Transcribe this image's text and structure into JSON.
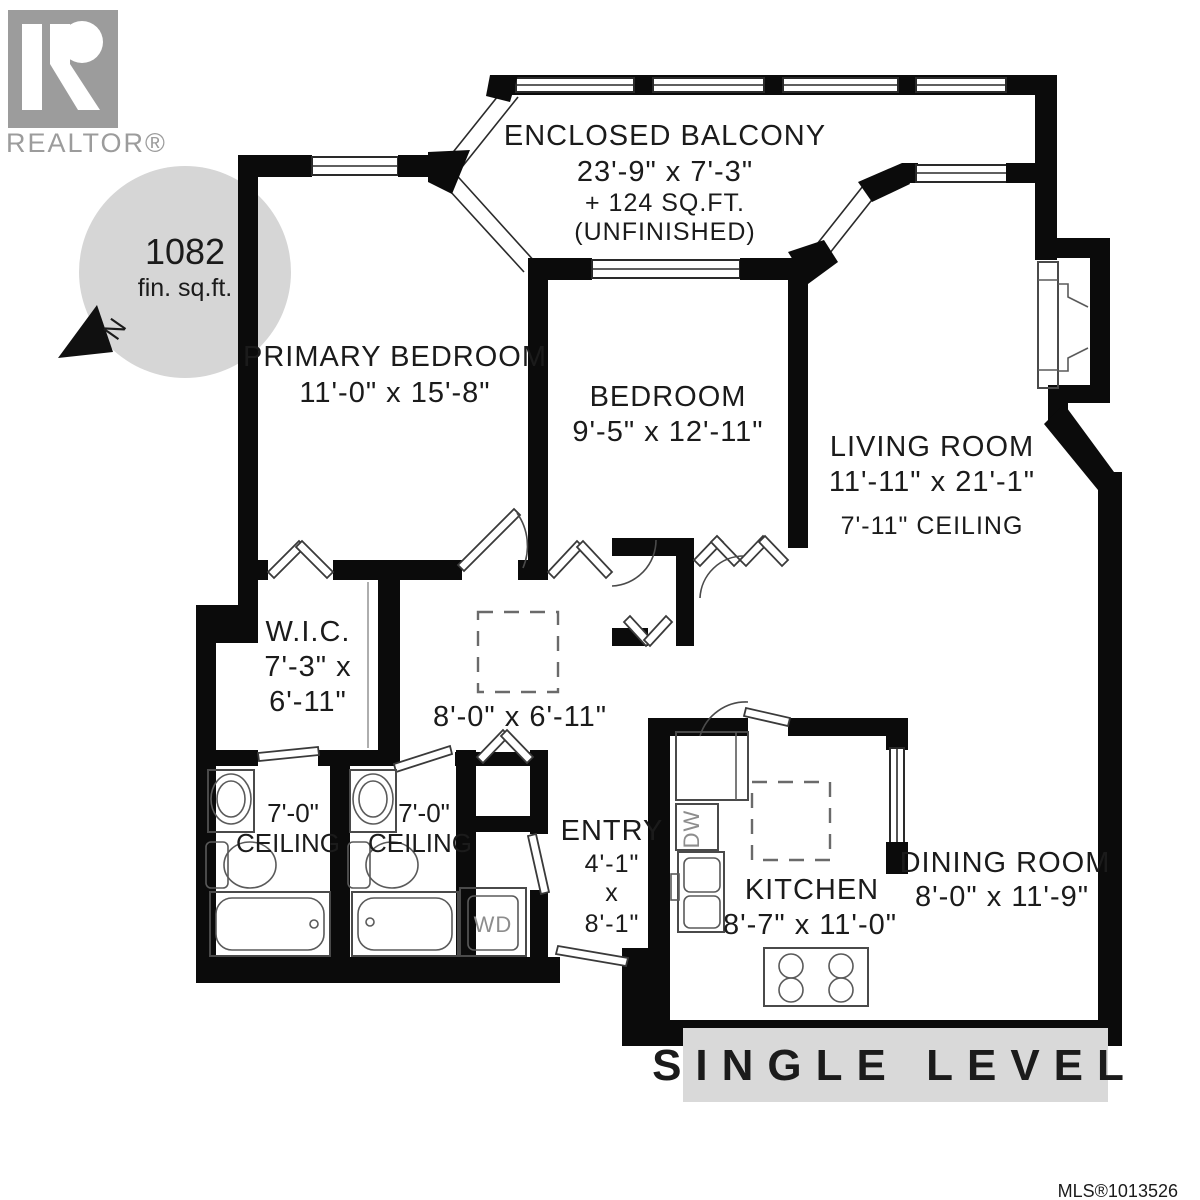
{
  "branding": {
    "realtor_logo_label": "REALTOR®",
    "mls_number": "MLS®1013526"
  },
  "area_badge": {
    "value": "1082",
    "unit": "fin. sq.ft.",
    "north_label": "N"
  },
  "banner": {
    "label": "SINGLE LEVEL"
  },
  "rooms": {
    "balcony": {
      "name": "ENCLOSED BALCONY",
      "dims": "23'-9\" x 7'-3\"",
      "extra_area": "+ 124 SQ.FT.",
      "note": "(UNFINISHED)"
    },
    "primary_bedroom": {
      "name": "PRIMARY BEDROOM",
      "dims": "11'-0\" x 15'-8\""
    },
    "bedroom": {
      "name": "BEDROOM",
      "dims": "9'-5\" x 12'-11\""
    },
    "living_room": {
      "name": "LIVING ROOM",
      "dims": "11'-11\" x 21'-1\"",
      "ceiling": "7'-11\" CEILING"
    },
    "wic": {
      "name": "W.I.C.",
      "dims_line1": "7'-3\" x",
      "dims_line2": "6'-11\""
    },
    "hall": {
      "dims": "8'-0\" x 6'-11\""
    },
    "bath1": {
      "ceiling_line1": "7'-0\"",
      "ceiling_line2": "CEILING"
    },
    "bath2": {
      "ceiling_line1": "7'-0\"",
      "ceiling_line2": "CEILING"
    },
    "entry": {
      "name": "ENTRY",
      "dims_line1": "4'-1\"",
      "dims_line2": "x",
      "dims_line3": "8'-1\""
    },
    "kitchen": {
      "name": "KITCHEN",
      "dims": "8'-7\" x 11'-0\""
    },
    "dining": {
      "name": "DINING ROOM",
      "dims": "8'-0\" x 11'-9\""
    }
  },
  "appliances": {
    "washer_dryer": "WD",
    "dishwasher": "DW"
  }
}
